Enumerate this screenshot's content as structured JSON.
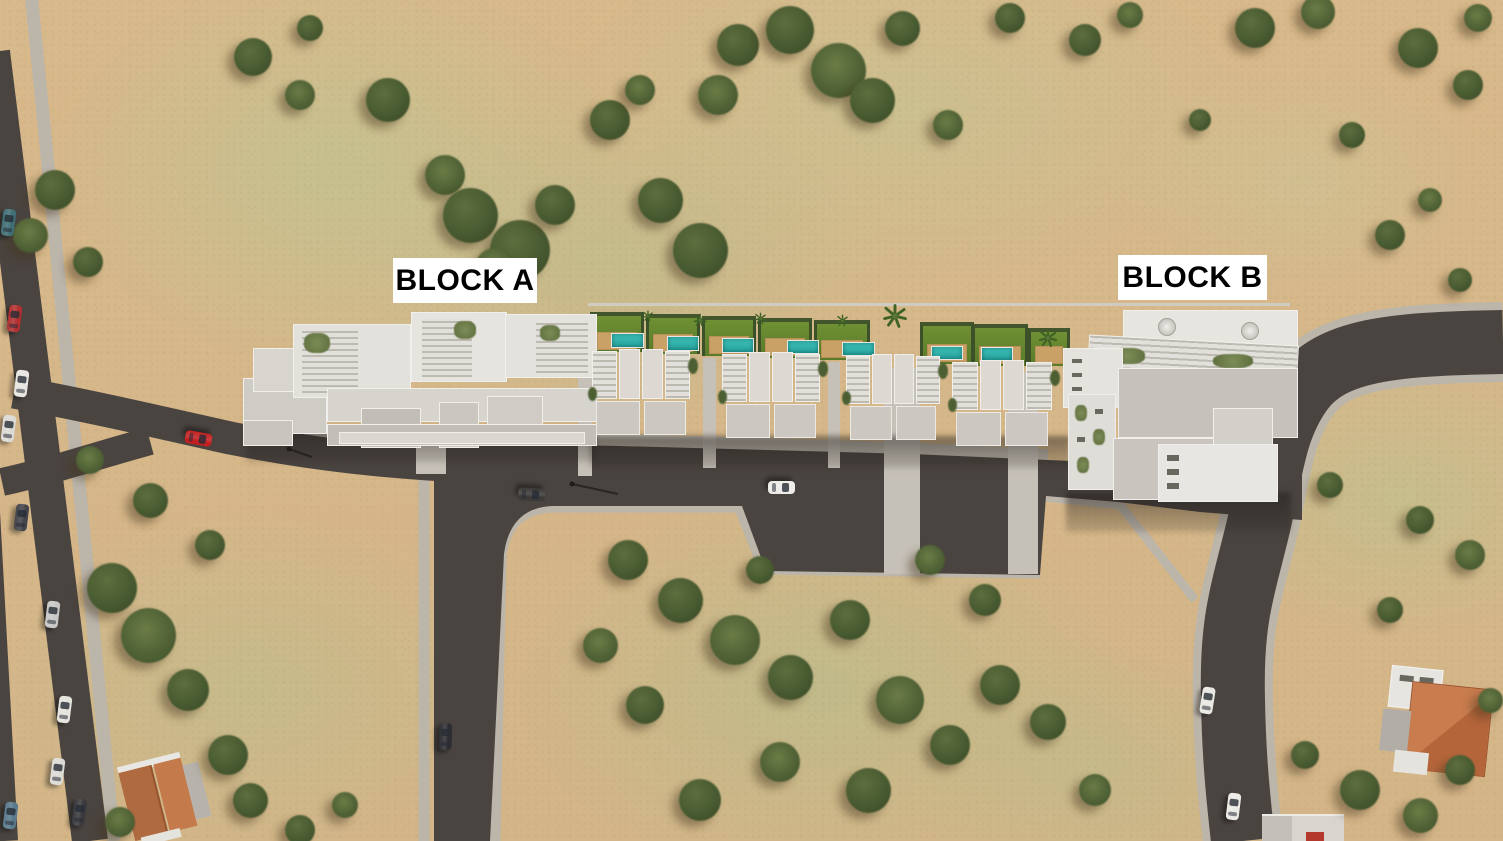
{
  "labels": {
    "block_a": "BLOCK A",
    "block_b": "BLOCK B"
  },
  "palette": {
    "sand": "#d8b98b",
    "grass": "#b9c492",
    "asphalt": "#4a4440",
    "sidewalk": "#bbb5aa",
    "building_white": "#e7e5e0",
    "roof_gray": "#c6c2bb",
    "pool": "#2fb3ac",
    "lawn": "#66862e",
    "deck": "#c9a166",
    "label_bg": "#ffffff",
    "label_text": "#000000",
    "tile_roof": "#c1764a",
    "car_red": "#c22020"
  },
  "scene": {
    "trees": [
      {
        "x": 253,
        "y": 57,
        "s": 38
      },
      {
        "x": 300,
        "y": 95,
        "s": 30
      },
      {
        "x": 310,
        "y": 28,
        "s": 26
      },
      {
        "x": 388,
        "y": 100,
        "s": 44
      },
      {
        "x": 445,
        "y": 175,
        "s": 40
      },
      {
        "x": 470,
        "y": 215,
        "s": 55
      },
      {
        "x": 520,
        "y": 250,
        "s": 60
      },
      {
        "x": 495,
        "y": 268,
        "s": 40
      },
      {
        "x": 555,
        "y": 205,
        "s": 40
      },
      {
        "x": 610,
        "y": 120,
        "s": 40
      },
      {
        "x": 640,
        "y": 90,
        "s": 30
      },
      {
        "x": 660,
        "y": 200,
        "s": 45
      },
      {
        "x": 700,
        "y": 250,
        "s": 55
      },
      {
        "x": 718,
        "y": 95,
        "s": 40
      },
      {
        "x": 738,
        "y": 45,
        "s": 42
      },
      {
        "x": 790,
        "y": 30,
        "s": 48
      },
      {
        "x": 838,
        "y": 70,
        "s": 55
      },
      {
        "x": 872,
        "y": 100,
        "s": 45
      },
      {
        "x": 902,
        "y": 28,
        "s": 35
      },
      {
        "x": 948,
        "y": 125,
        "s": 30
      },
      {
        "x": 1010,
        "y": 18,
        "s": 30
      },
      {
        "x": 1085,
        "y": 40,
        "s": 32
      },
      {
        "x": 1130,
        "y": 15,
        "s": 26
      },
      {
        "x": 1200,
        "y": 120,
        "s": 22
      },
      {
        "x": 1255,
        "y": 28,
        "s": 40
      },
      {
        "x": 1318,
        "y": 12,
        "s": 34
      },
      {
        "x": 1418,
        "y": 48,
        "s": 40
      },
      {
        "x": 1468,
        "y": 85,
        "s": 30
      },
      {
        "x": 1478,
        "y": 18,
        "s": 28
      },
      {
        "x": 1352,
        "y": 135,
        "s": 26
      },
      {
        "x": 1390,
        "y": 235,
        "s": 30
      },
      {
        "x": 1430,
        "y": 200,
        "s": 24
      },
      {
        "x": 1460,
        "y": 280,
        "s": 24
      },
      {
        "x": 55,
        "y": 190,
        "s": 40
      },
      {
        "x": 30,
        "y": 235,
        "s": 35
      },
      {
        "x": 88,
        "y": 262,
        "s": 30
      },
      {
        "x": 112,
        "y": 588,
        "s": 50
      },
      {
        "x": 148,
        "y": 635,
        "s": 55
      },
      {
        "x": 188,
        "y": 690,
        "s": 42
      },
      {
        "x": 228,
        "y": 755,
        "s": 40
      },
      {
        "x": 120,
        "y": 822,
        "s": 30
      },
      {
        "x": 250,
        "y": 800,
        "s": 35
      },
      {
        "x": 300,
        "y": 830,
        "s": 30
      },
      {
        "x": 345,
        "y": 805,
        "s": 26
      },
      {
        "x": 150,
        "y": 500,
        "s": 35
      },
      {
        "x": 210,
        "y": 545,
        "s": 30
      },
      {
        "x": 90,
        "y": 460,
        "s": 28
      },
      {
        "x": 628,
        "y": 560,
        "s": 40
      },
      {
        "x": 680,
        "y": 600,
        "s": 45
      },
      {
        "x": 735,
        "y": 640,
        "s": 50
      },
      {
        "x": 790,
        "y": 677,
        "s": 45
      },
      {
        "x": 850,
        "y": 620,
        "s": 40
      },
      {
        "x": 900,
        "y": 700,
        "s": 48
      },
      {
        "x": 950,
        "y": 745,
        "s": 40
      },
      {
        "x": 868,
        "y": 790,
        "s": 45
      },
      {
        "x": 780,
        "y": 762,
        "s": 40
      },
      {
        "x": 700,
        "y": 800,
        "s": 42
      },
      {
        "x": 645,
        "y": 705,
        "s": 38
      },
      {
        "x": 600,
        "y": 645,
        "s": 35
      },
      {
        "x": 1000,
        "y": 685,
        "s": 40
      },
      {
        "x": 1048,
        "y": 722,
        "s": 36
      },
      {
        "x": 930,
        "y": 560,
        "s": 30
      },
      {
        "x": 985,
        "y": 600,
        "s": 32
      },
      {
        "x": 760,
        "y": 570,
        "s": 28
      },
      {
        "x": 1095,
        "y": 790,
        "s": 32
      },
      {
        "x": 1330,
        "y": 485,
        "s": 26
      },
      {
        "x": 1420,
        "y": 520,
        "s": 28
      },
      {
        "x": 1470,
        "y": 555,
        "s": 30
      },
      {
        "x": 1390,
        "y": 610,
        "s": 26
      },
      {
        "x": 1360,
        "y": 790,
        "s": 40
      },
      {
        "x": 1420,
        "y": 815,
        "s": 35
      },
      {
        "x": 1460,
        "y": 770,
        "s": 30
      },
      {
        "x": 1305,
        "y": 755,
        "s": 28
      },
      {
        "x": 1490,
        "y": 700,
        "s": 25
      }
    ],
    "cars": [
      {
        "x": 8,
        "y": 222,
        "r": 7,
        "c": "#3f6f74"
      },
      {
        "x": 14,
        "y": 318,
        "r": 7,
        "c": "#b03030"
      },
      {
        "x": 21,
        "y": 383,
        "r": 7,
        "c": "#e8e6e0"
      },
      {
        "x": 8,
        "y": 428,
        "r": 7,
        "c": "#dcdad4"
      },
      {
        "x": 21,
        "y": 517,
        "r": 7,
        "c": "#43434a"
      },
      {
        "x": 52,
        "y": 614,
        "r": 7,
        "c": "#c8c8c6"
      },
      {
        "x": 64,
        "y": 709,
        "r": 7,
        "c": "#e5e3dd"
      },
      {
        "x": 57,
        "y": 771,
        "r": 7,
        "c": "#dddbd5"
      },
      {
        "x": 10,
        "y": 815,
        "r": 7,
        "c": "#5a7a8c"
      },
      {
        "x": 79,
        "y": 812,
        "r": 7,
        "c": "#3a3a3e"
      },
      {
        "x": 198,
        "y": 438,
        "r": 100,
        "c": "#c22020"
      },
      {
        "x": 531,
        "y": 494,
        "r": 93,
        "c": "#3c3a38"
      },
      {
        "x": 781,
        "y": 487,
        "r": 90,
        "c": "#eeece8"
      },
      {
        "x": 445,
        "y": 736,
        "r": 2,
        "c": "#2e2e32"
      },
      {
        "x": 1207,
        "y": 700,
        "r": 9,
        "c": "#e9e7e2"
      },
      {
        "x": 1233,
        "y": 806,
        "r": 7,
        "c": "#eceae5"
      }
    ],
    "gardens": [
      {
        "x": 590,
        "y": 312,
        "w": 54,
        "h": 40
      },
      {
        "x": 646,
        "y": 314,
        "w": 54,
        "h": 40
      },
      {
        "x": 702,
        "y": 316,
        "w": 54,
        "h": 40
      },
      {
        "x": 758,
        "y": 318,
        "w": 54,
        "h": 40
      },
      {
        "x": 814,
        "y": 320,
        "w": 56,
        "h": 40
      },
      {
        "x": 920,
        "y": 322,
        "w": 54,
        "h": 42
      },
      {
        "x": 972,
        "y": 324,
        "w": 56,
        "h": 42
      },
      {
        "x": 1028,
        "y": 328,
        "w": 42,
        "h": 38
      }
    ],
    "pools": [
      {
        "x": 611,
        "y": 333,
        "w": 33,
        "h": 15
      },
      {
        "x": 667,
        "y": 336,
        "w": 32,
        "h": 15
      },
      {
        "x": 722,
        "y": 338,
        "w": 32,
        "h": 15
      },
      {
        "x": 787,
        "y": 340,
        "w": 32,
        "h": 14
      },
      {
        "x": 842,
        "y": 342,
        "w": 33,
        "h": 14
      },
      {
        "x": 931,
        "y": 346,
        "w": 32,
        "h": 14
      },
      {
        "x": 981,
        "y": 347,
        "w": 32,
        "h": 14
      }
    ],
    "palms": [
      {
        "x": 895,
        "y": 316,
        "s": 26
      },
      {
        "x": 1048,
        "y": 338,
        "s": 20
      },
      {
        "x": 700,
        "y": 320,
        "s": 14
      },
      {
        "x": 760,
        "y": 318,
        "s": 13
      },
      {
        "x": 842,
        "y": 320,
        "s": 13
      },
      {
        "x": 648,
        "y": 316,
        "s": 12
      }
    ],
    "villas": [
      {
        "x": 592,
        "y": 349,
        "w": 100,
        "h": 94
      },
      {
        "x": 722,
        "y": 352,
        "w": 100,
        "h": 94
      },
      {
        "x": 846,
        "y": 354,
        "w": 96,
        "h": 92
      },
      {
        "x": 952,
        "y": 360,
        "w": 102,
        "h": 96
      }
    ]
  }
}
